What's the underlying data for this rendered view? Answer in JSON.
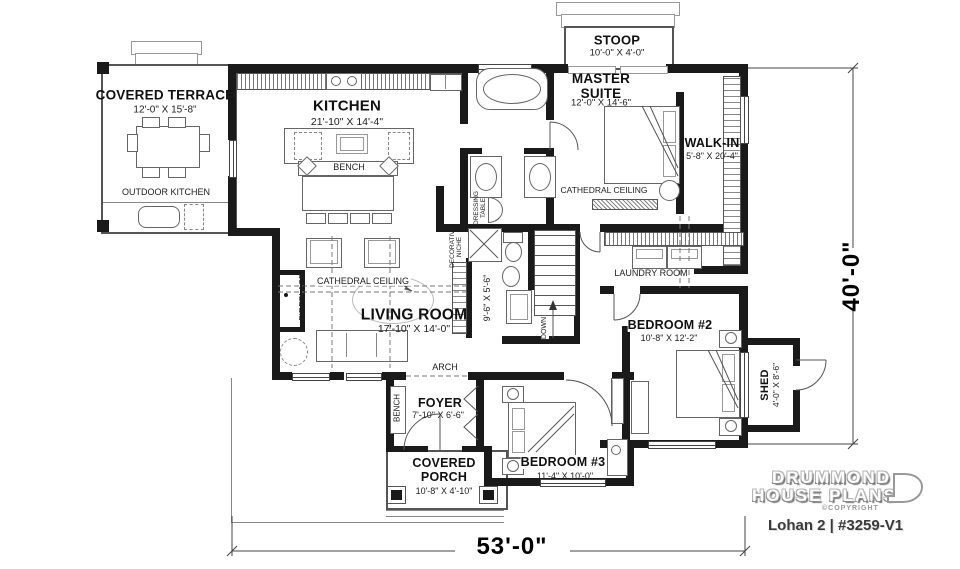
{
  "plan": {
    "brand_line1": "DRUMMOND",
    "brand_line2": "HOUSE PLANS",
    "copyright": "©COPYRIGHT",
    "title": "Lohan 2 | #3259-V1",
    "width_dim": "53'-0\"",
    "height_dim": "40'-0\""
  },
  "rooms": {
    "covered_terrace": {
      "label": "COVERED TERRACE",
      "dims": "12'-0\" X 15'-8\""
    },
    "outdoor_kitchen": {
      "label": "OUTDOOR KITCHEN"
    },
    "kitchen": {
      "label": "KITCHEN",
      "dims": "21'-10\" X 14'-4\""
    },
    "kitchen_bench": {
      "label": "BENCH"
    },
    "stoop": {
      "label": "STOOP",
      "dims": "10'-0\" X 4'-0\""
    },
    "master_suite": {
      "label": "MASTER\nSUITE",
      "dims": "12'-0\" X 14'-6\""
    },
    "master_ceiling": {
      "label": "CATHEDRAL CEILING"
    },
    "walk_in": {
      "label": "WALK-IN",
      "dims": "5'-8\" X 20'-4\""
    },
    "living_room": {
      "label": "LIVING ROOM",
      "dims": "17'-10\" X 14'-0\""
    },
    "living_ceiling": {
      "label": "CATHEDRAL CEILING"
    },
    "fireplace": {
      "label": "FIREPLACE"
    },
    "arch": {
      "label": "ARCH"
    },
    "decorative_niche": {
      "label": "DECORATIVE\nNICHE"
    },
    "dressing_table": {
      "label": "DRESSING\nTABLE"
    },
    "hallway": {
      "dims": "9'-6\" X 5'-6\""
    },
    "stairs": {
      "label": "DOWN"
    },
    "laundry": {
      "label": "LAUNDRY ROOM"
    },
    "bedroom2": {
      "label": "BEDROOM #2",
      "dims": "10'-8\" X 12'-2\""
    },
    "shed": {
      "label": "SHED",
      "dims": "4'-0\" X 8'-6\""
    },
    "foyer": {
      "label": "FOYER",
      "dims": "7'-10\" X 6'-6\""
    },
    "foyer_bench": {
      "label": "BENCH"
    },
    "bedroom3": {
      "label": "BEDROOM #3",
      "dims": "11'-4\" X 10'-0\""
    },
    "covered_porch": {
      "label": "COVERED\nPORCH",
      "dims": "10'-8\" X 4'-10\""
    }
  },
  "colors": {
    "wall": "#1a1a1a",
    "line": "#666666",
    "text": "#1a1a1a",
    "brand_text": "#3d3d3d"
  }
}
